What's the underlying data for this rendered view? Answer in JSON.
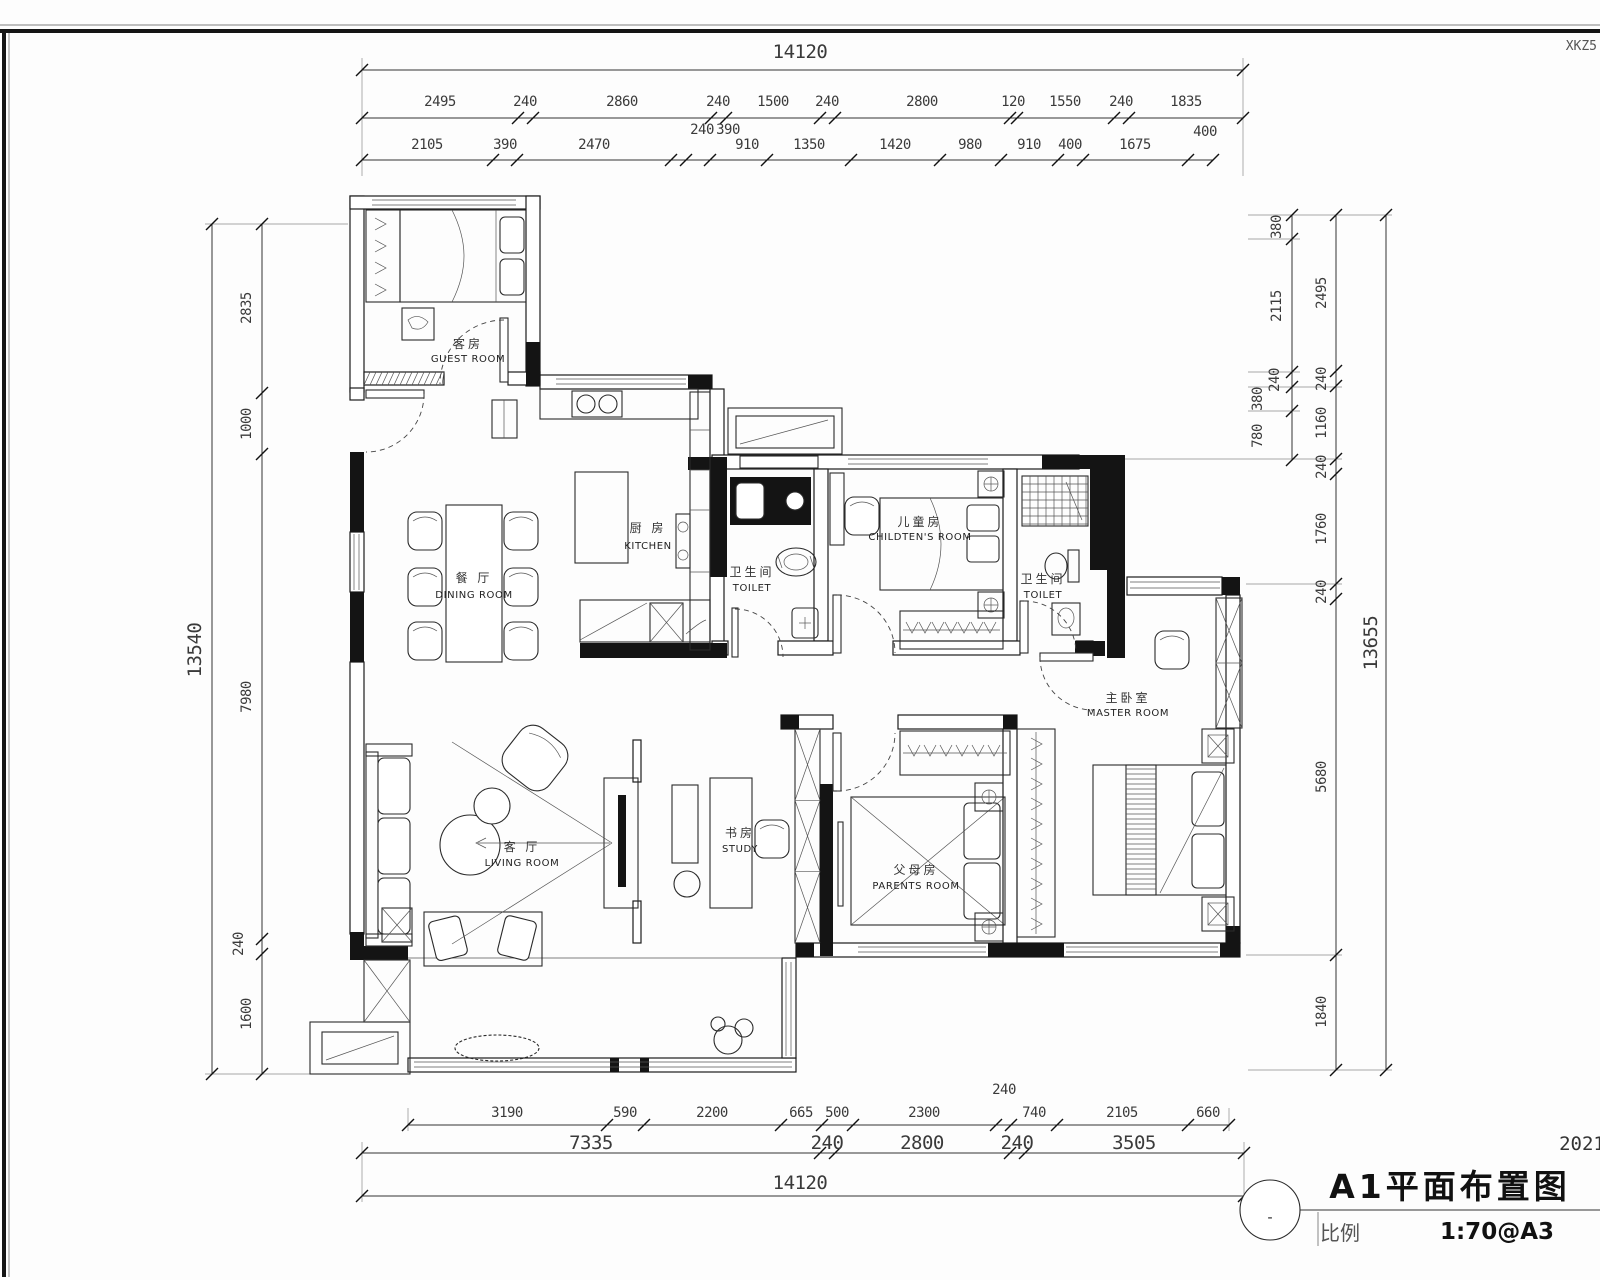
{
  "meta": {
    "corner_note": "XKZ5",
    "year_note": "2021"
  },
  "title_block": {
    "title": "A1平面布置图",
    "scale_label": "比例",
    "scale_value": "1:70@A3",
    "bubble_mark": "-"
  },
  "rooms": {
    "guest": {
      "zh": "客房",
      "en": "GUEST ROOM"
    },
    "kitchen": {
      "zh": "厨 房",
      "en": "KITCHEN"
    },
    "dining": {
      "zh": "餐 厅",
      "en": "DINING ROOM"
    },
    "toilet1": {
      "zh": "卫生间",
      "en": "TOILET"
    },
    "children": {
      "zh": "儿童房",
      "en": "CHILDTEN'S ROOM"
    },
    "toilet2": {
      "zh": "卫生间",
      "en": "TOILET"
    },
    "master": {
      "zh": "主卧室",
      "en": "MASTER ROOM"
    },
    "living": {
      "zh": "客 厅",
      "en": "LIVING ROOM"
    },
    "study": {
      "zh": "书房",
      "en": "STUDY"
    },
    "parents": {
      "zh": "父母房",
      "en": "PARENTS ROOM"
    }
  },
  "dims": {
    "top_total": "14120",
    "top_row2": [
      "2495",
      "240",
      "2860",
      "240",
      "1500",
      "240",
      "2800",
      "120",
      "1550",
      "240",
      "1835"
    ],
    "top_row3": [
      "2105",
      "390",
      "2470",
      "240",
      "390",
      "910",
      "1350",
      "1420",
      "980",
      "910",
      "400",
      "1675",
      "400"
    ],
    "left_total": "13540",
    "left_chain": [
      "2835",
      "1000",
      "7980",
      "240",
      "1600"
    ],
    "right_inner": [
      "380",
      "2115",
      "240",
      "380",
      "780"
    ],
    "right_mid": [
      "2495",
      "240",
      "1160",
      "240",
      "1760",
      "240",
      "5680",
      "1840"
    ],
    "right_total": "13655",
    "bottom_row1": [
      "3190",
      "590",
      "2200",
      "665",
      "500",
      "2300",
      "240",
      "740",
      "2105",
      "660"
    ],
    "bottom_row2": [
      "7335",
      "240",
      "2800",
      "240",
      "3505"
    ],
    "bottom_total": "14120"
  }
}
